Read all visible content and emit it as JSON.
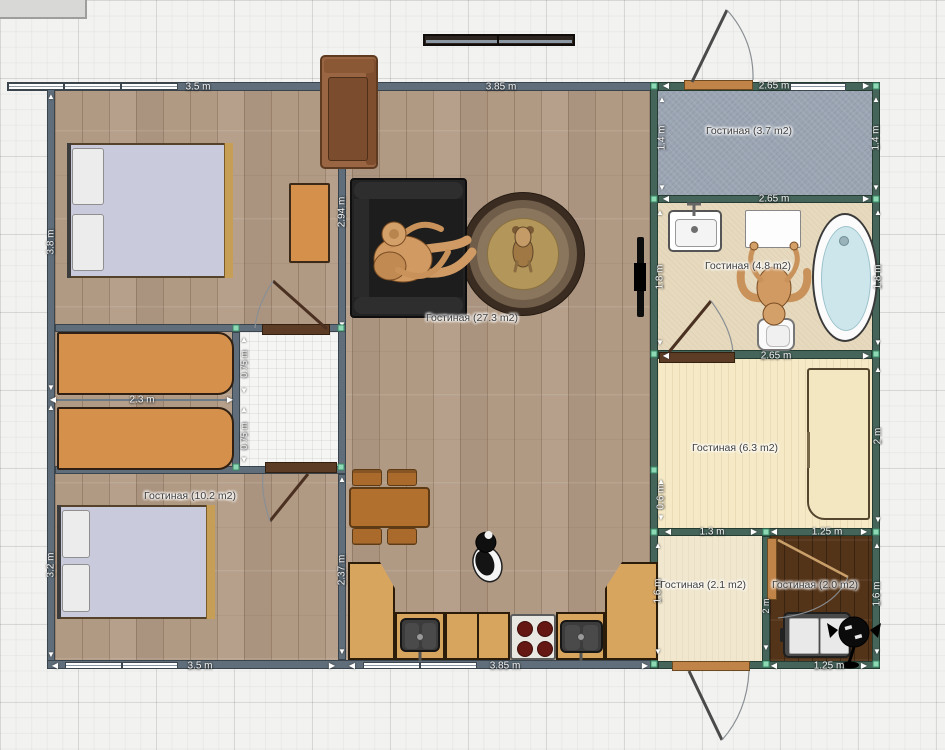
{
  "editor": {
    "canvas": "floor-plan-grid"
  },
  "rooms": {
    "living": {
      "label": "Гостиная (27.3 m2)"
    },
    "bedroom_lower": {
      "label": "Гостиная (10.2 m2)"
    },
    "entry": {
      "label": "Гостиная (3.7 m2)"
    },
    "bathroom": {
      "label": "Гостиная (4.8 m2)"
    },
    "dressing": {
      "label": "Гостиная (6.3 m2)"
    },
    "hall": {
      "label": "Гостиная (2.1 m2)"
    },
    "pantry": {
      "label": "Гостиная (2.0 m2)"
    }
  },
  "dims": {
    "top_bedroom": "3.5 m",
    "top_living": "3.85 m",
    "entry_top": "2.65 m",
    "left_bedroom1": "3.8 m",
    "left_bedroom2": "3.2 m",
    "bedroom_inner": "2.94 m",
    "wardrobe_len": "2.3 m",
    "corridor_a": "0.75 m",
    "corridor_b": "0.75 m",
    "kitchen_inner": "2.37 m",
    "bottom_bedroom": "3.5 m",
    "bottom_kitchen": "3.85 m",
    "entry_left": "1.4 m",
    "entry_right": "1.4 m",
    "entry_bottom": "2.65 m",
    "bath_left": "1.8 m",
    "bath_right": "1.8 m",
    "bath_bottom": "2.65 m",
    "dress_left": "0.6 m",
    "dress_right": "2 m",
    "dress_bottom_a": "1.3 m",
    "dress_bottom_b": "1.25 m",
    "hall_left": "1.6 m",
    "pantry_right": "1.6 m",
    "pantry_bottom": "1.25 m",
    "pantry_door": "2 m"
  },
  "colors": {
    "selection_wall": "#45645a",
    "marker": "#8ed9b5",
    "wall": "#5f6e7a",
    "wood_floor": "#b19a84",
    "entry_floor": "#9aa4b2",
    "bath_floor": "#e6d9bd",
    "dressing_floor": "#f5e9c6",
    "hall_floor": "#f0e7ce",
    "pantry_floor": "#543419",
    "bed_blanket": "#c9cadb",
    "cabinet": "#d5914b",
    "sofa": "#232323",
    "counter": "#d8a55e"
  }
}
